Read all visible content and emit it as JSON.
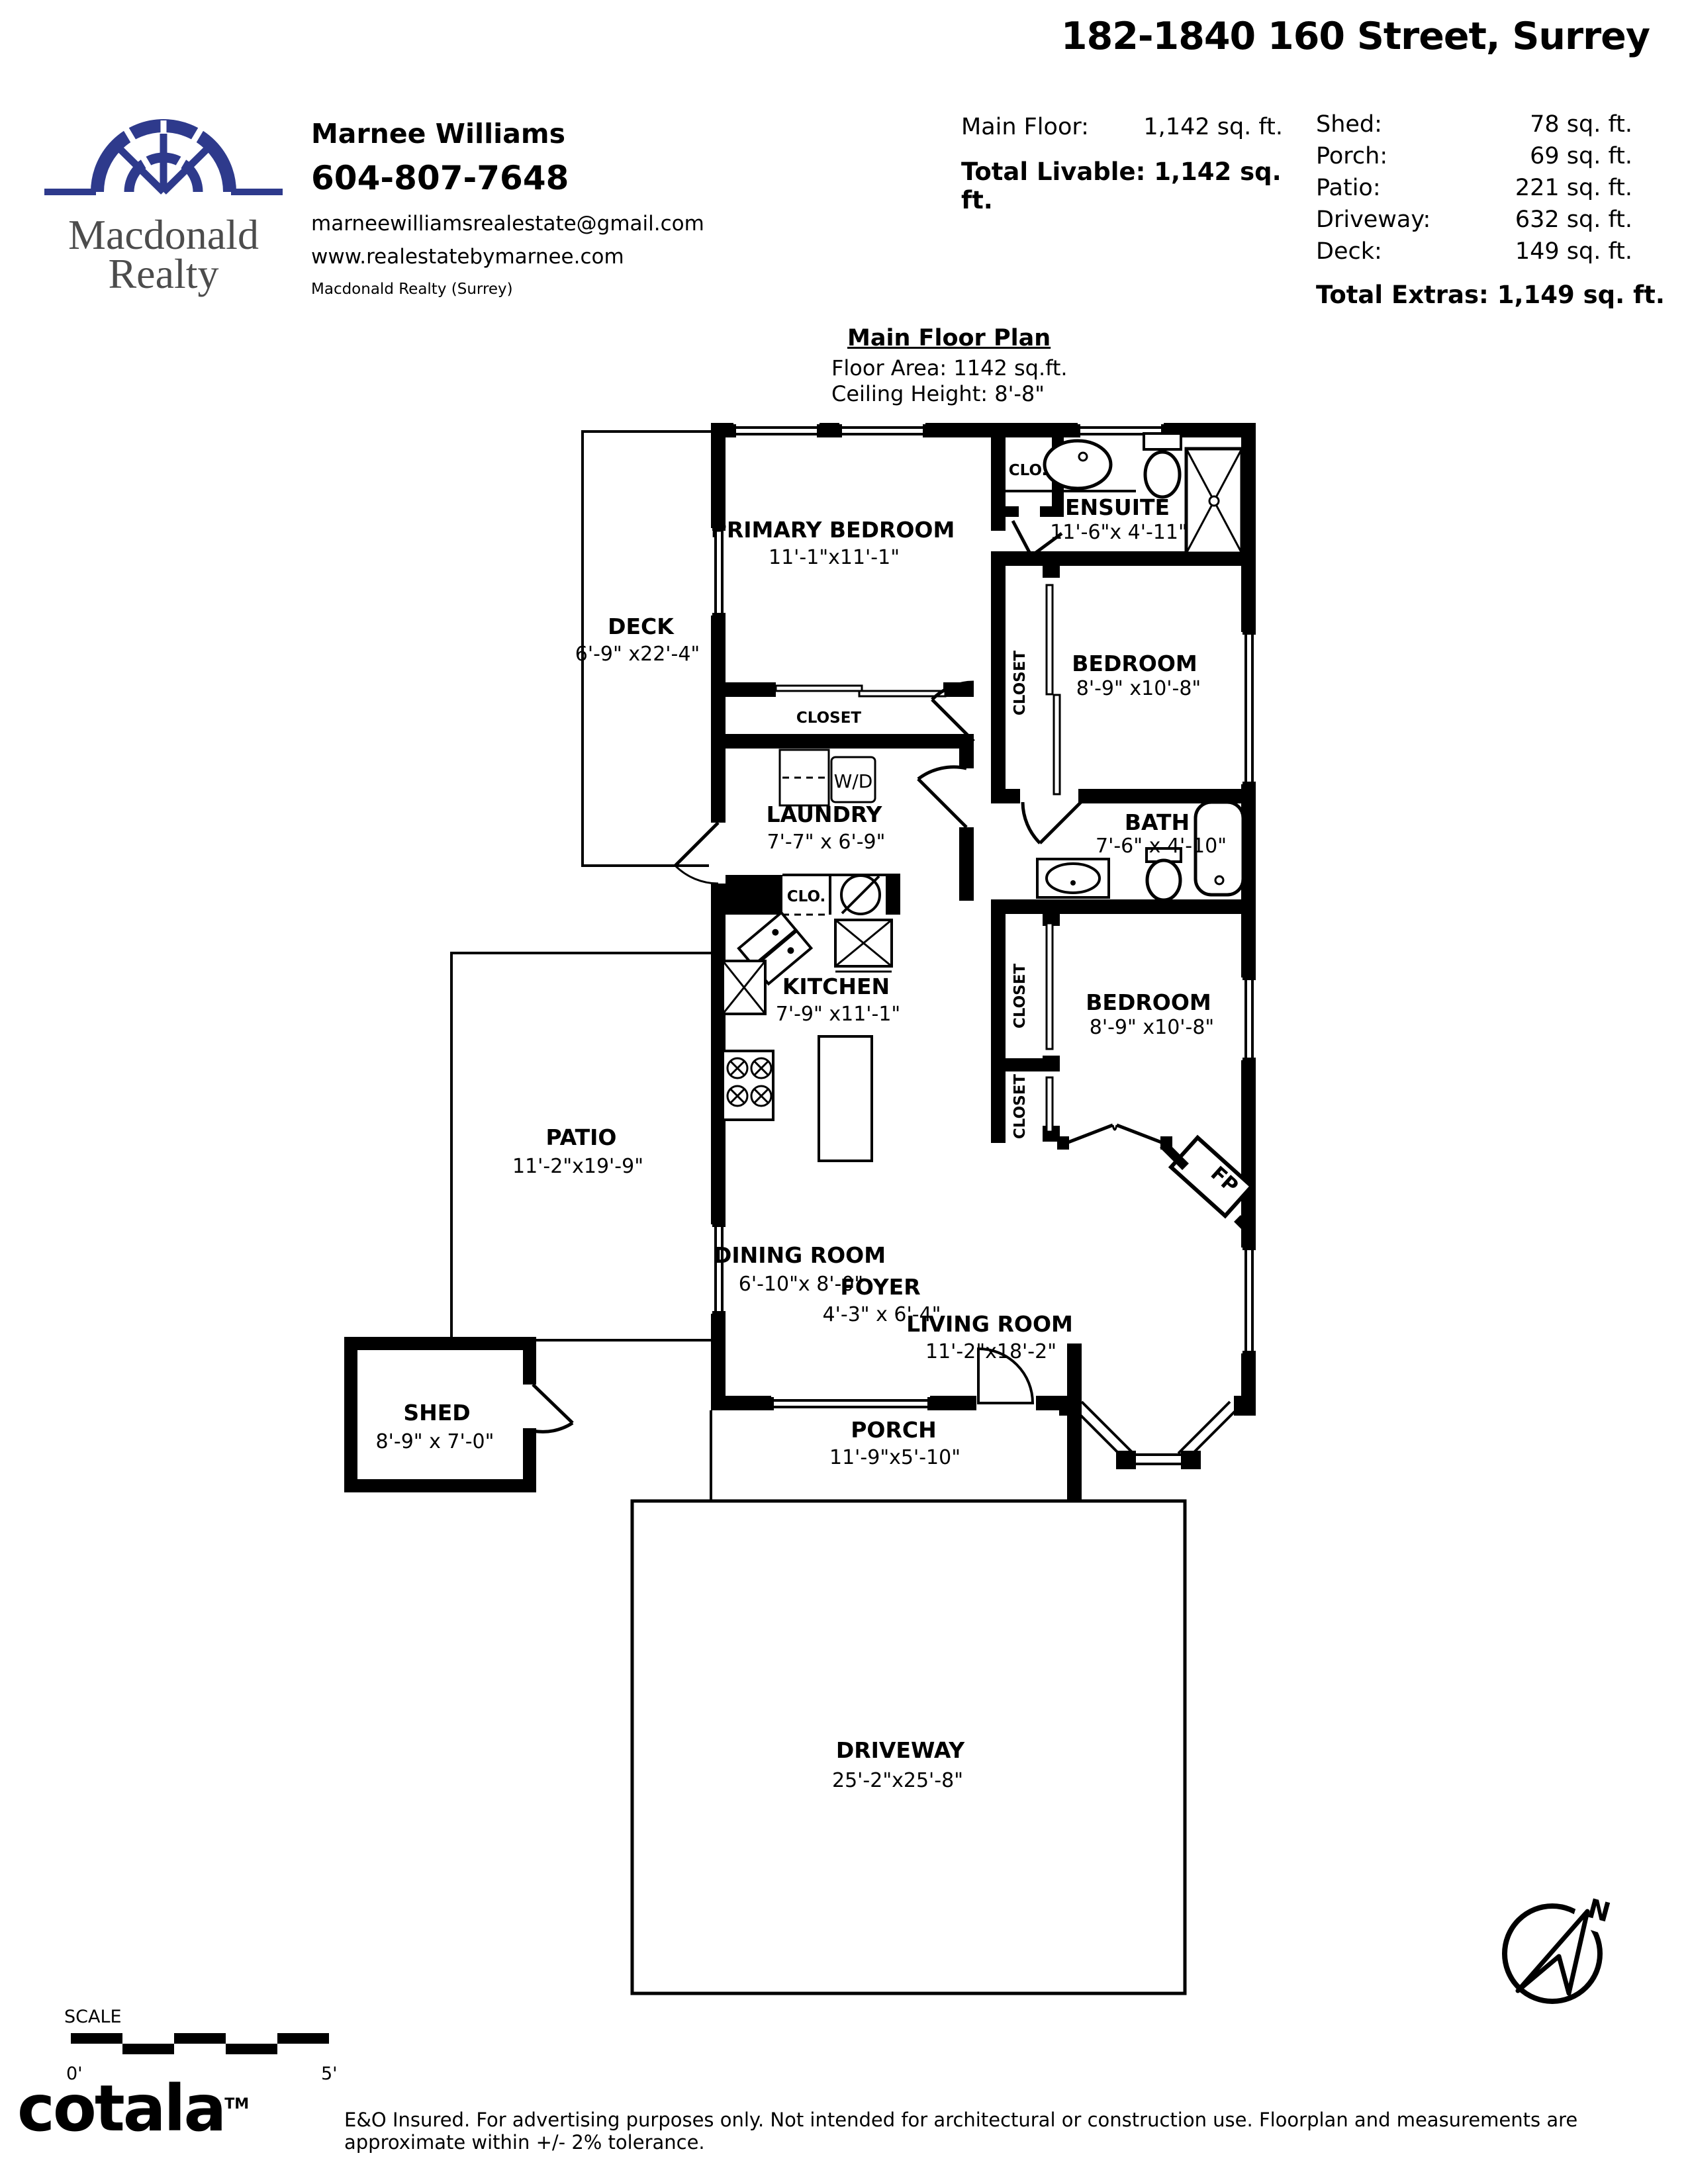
{
  "header": {
    "address": "182-1840 160 Street, Surrey",
    "agent": {
      "name": "Marnee Williams",
      "phone": "604-807-7648",
      "email": "marneewilliamsrealestate@gmail.com",
      "website": "www.realestatebymarnee.com",
      "office": "Macdonald Realty (Surrey)"
    },
    "brokerage": {
      "line1": "Macdonald",
      "line2": "Realty"
    }
  },
  "areas": {
    "main_floor_label": "Main Floor:",
    "main_floor_value": "1,142 sq. ft.",
    "total_livable": "Total Livable: 1,142 sq. ft.",
    "extras": [
      {
        "label": "Shed:",
        "value": "78 sq. ft."
      },
      {
        "label": "Porch:",
        "value": "69 sq. ft."
      },
      {
        "label": "Patio:",
        "value": "221 sq. ft."
      },
      {
        "label": "Driveway:",
        "value": "632 sq. ft."
      },
      {
        "label": "Deck:",
        "value": "149 sq. ft."
      }
    ],
    "total_extras": "Total Extras: 1,149 sq. ft."
  },
  "plan": {
    "title": "Main Floor Plan",
    "floor_area": "Floor Area: 1142 sq.ft.",
    "ceiling_height": "Ceiling Height: 8'-8\"",
    "rooms": [
      {
        "name": "PRIMARY BEDROOM",
        "dims": "11'-1\"x11'-1\""
      },
      {
        "name": "ENSUITE",
        "dims": "11'-6\"x 4'-11\""
      },
      {
        "name": "BEDROOM",
        "dims": "8'-9\" x10'-8\""
      },
      {
        "name": "BATH",
        "dims": "7'-6\" x 4'-10\""
      },
      {
        "name": "BEDROOM",
        "dims": "8'-9\" x10'-8\""
      },
      {
        "name": "LAUNDRY",
        "dims": "7'-7\" x 6'-9\""
      },
      {
        "name": "KITCHEN",
        "dims": "7'-9\" x11'-1\""
      },
      {
        "name": "DINING ROOM",
        "dims": "6'-10\"x 8'-0\""
      },
      {
        "name": "FOYER",
        "dims": "4'-3\" x 6'-4\""
      },
      {
        "name": "LIVING ROOM",
        "dims": "11'-2\"x18'-2\""
      },
      {
        "name": "DECK",
        "dims": "6'-9\" x22'-4\""
      },
      {
        "name": "PATIO",
        "dims": "11'-2\"x19'-9\""
      },
      {
        "name": "PORCH",
        "dims": "11'-9\"x5'-10\""
      },
      {
        "name": "SHED",
        "dims": "8'-9\" x 7'-0\""
      },
      {
        "name": "DRIVEWAY",
        "dims": "25'-2\"x25'-8\""
      }
    ],
    "labels": {
      "clo": "CLO.",
      "closet": "CLOSET",
      "wd": "W/D",
      "fp": "FP"
    }
  },
  "footer": {
    "scale_label": "SCALE",
    "scale_start": "0'",
    "scale_end": "5'",
    "logo": "cotala",
    "tm": "TM",
    "disclaimer": "E&O Insured. For advertising purposes only. Not intended for architectural or construction use. Floorplan and measurements are approximate within +/- 2% tolerance."
  },
  "compass": {
    "north": "N"
  }
}
